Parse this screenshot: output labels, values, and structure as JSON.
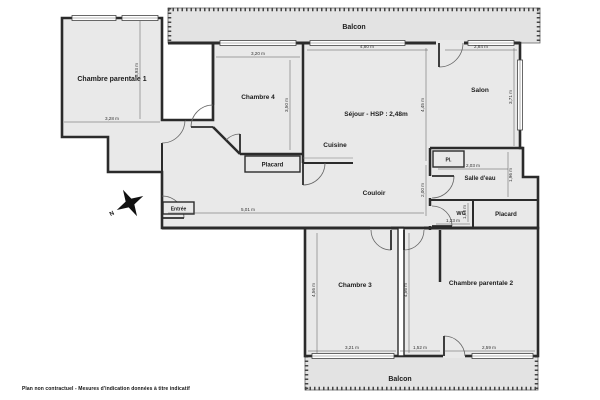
{
  "plan": {
    "rooms": {
      "balcon_top": "Balcon",
      "cp1": "Chambre parentale 1",
      "c4": "Chambre 4",
      "sejour": "Séjour - HSP : 2,48m",
      "salon": "Salon",
      "cuisine": "Cuisine",
      "placard_hall": "Placard",
      "couloir": "Couloir",
      "entree": "Entrée",
      "pl": "Pl.",
      "sde": "Salle d'eau",
      "wc": "WC",
      "placard_sud": "Placard",
      "c3": "Chambre 3",
      "cp2": "Chambre parentale 2",
      "balcon_bas": "Balcon"
    },
    "dims": {
      "cp1_w": "3,28 m",
      "cp1_h": "3,93 m",
      "c4_w": "3,20 m",
      "c4_h": "3,50 m",
      "sejour_w": "4,80 m",
      "sejour_h": "4,45 m",
      "salon_w": "2,84 m",
      "salon_h": "3,71 m",
      "couloir_w": "5,01 m",
      "couloir_h": "2,00 m",
      "sde_w": "2,03 m",
      "sde_h": "1,96 m",
      "wc_w": "1,23 m",
      "wc_h": "1,50 m",
      "c3_h": "4,56 m",
      "mid_h": "4,56 m",
      "c3_w": "3,21 m",
      "mid_w": "1,52 m",
      "cp2_w": "2,59 m"
    },
    "compass": {
      "north": "N"
    },
    "footer": {
      "note": "Plan non contractuel - Mesures d'indication données à titre indicatif"
    },
    "colors": {
      "floor": "#e9e9e9",
      "balcony": "#e3e3e3",
      "wall": "#2b2b2b",
      "dim": "#555555"
    }
  }
}
